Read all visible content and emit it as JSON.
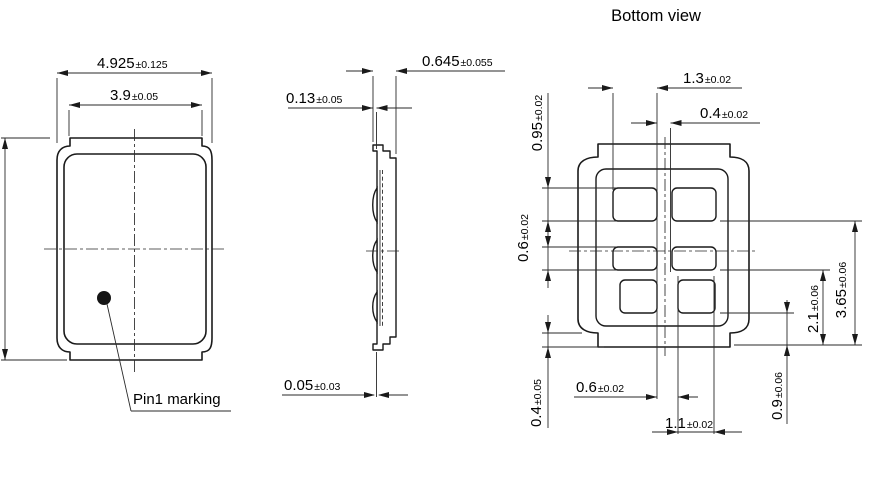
{
  "bottom_view_title": "Bottom view",
  "front_view": {
    "pin1_label": "Pin1 marking"
  },
  "dims": {
    "front_outer": {
      "value": "4.925",
      "tol": "±0.125"
    },
    "front_inner": {
      "value": "3.9",
      "tol": "±0.05"
    },
    "side_thickness": {
      "value": "0.645",
      "tol": "±0.055"
    },
    "side_lid_thickness": {
      "value": "0.13",
      "tol": "±0.05"
    },
    "side_standoff": {
      "value": "0.05",
      "tol": "±0.03"
    },
    "pad_width_main": {
      "value": "1.3",
      "tol": "±0.02"
    },
    "pad_gap_center": {
      "value": "0.4",
      "tol": "±0.02"
    },
    "pad_height_end": {
      "value": "0.95",
      "tol": "±0.02"
    },
    "pad_height_mid": {
      "value": "0.6",
      "tol": "±0.02"
    },
    "edge_to_tab": {
      "value": "0.4",
      "tol": "±0.05"
    },
    "pad_span_inner": {
      "value": "2.1",
      "tol": "±0.06"
    },
    "pad_span_outer": {
      "value": "3.65",
      "tol": "±0.06"
    },
    "corner_pad_height": {
      "value": "0.9",
      "tol": "±0.06"
    },
    "corner_pad_gap": {
      "value": "0.6",
      "tol": "±0.02"
    },
    "corner_pad_width": {
      "value": "1.1",
      "tol": "±0.02"
    }
  }
}
